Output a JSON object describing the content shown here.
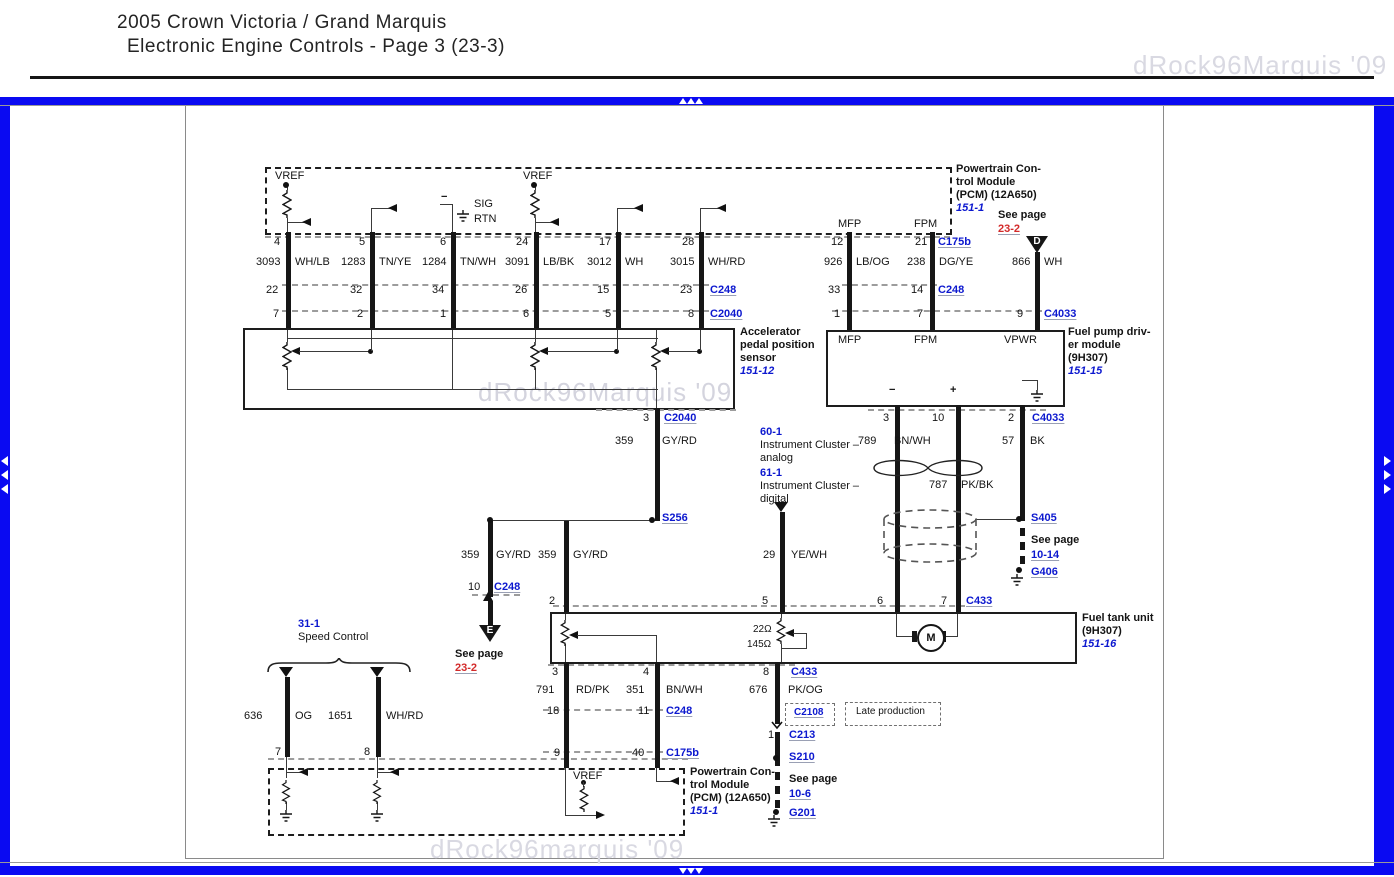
{
  "header": {
    "title1": "2005 Crown Victoria / Grand Marquis",
    "title2": "Electronic Engine Controls - Page 3 (23-3)"
  },
  "watermarks": {
    "top_right": "dRock96Marquis '09",
    "center": "dRock96Marquis '09",
    "bottom": "dRock96marquis '09"
  },
  "pcm_top": {
    "vref_left": "VREF",
    "vref_right": "VREF",
    "minus": "−",
    "sig": "SIG",
    "rtn": "RTN",
    "mfp": "MFP",
    "fpm": "FPM",
    "label1": "Powertrain Con-",
    "label2": "trol Module",
    "label3": "(PCM) (12A650)",
    "ref": "151-1",
    "see_page": "See page",
    "see_page_num": "23-2",
    "d": "D"
  },
  "pins": {
    "row1": [
      "4",
      "5",
      "6",
      "24",
      "17",
      "28"
    ],
    "row1r": [
      "12",
      "21"
    ],
    "c175b": "C175b",
    "row2": [
      "22",
      "32",
      "34",
      "26",
      "15",
      "23"
    ],
    "c248l": "C248",
    "row2r": [
      "33",
      "14"
    ],
    "c248r": "C248",
    "row3": [
      "7",
      "2",
      "1",
      "6",
      "5",
      "8"
    ],
    "c2040": "C2040",
    "row3r": [
      "1",
      "7",
      "9"
    ],
    "c4033": "C4033"
  },
  "wires": {
    "w3093": {
      "g": "3093",
      "c": "WH/LB"
    },
    "w1283": {
      "g": "1283",
      "c": "TN/YE"
    },
    "w1284": {
      "g": "1284",
      "c": "TN/WH"
    },
    "w3091": {
      "g": "3091",
      "c": "LB/BK"
    },
    "w3012": {
      "g": "3012",
      "c": "WH"
    },
    "w3015": {
      "g": "3015",
      "c": "WH/RD"
    },
    "w926": {
      "g": "926",
      "c": "LB/OG"
    },
    "w238": {
      "g": "238",
      "c": "DG/YE"
    },
    "w866": {
      "g": "866",
      "c": "WH"
    },
    "w359a": {
      "g": "359",
      "c": "GY/RD"
    },
    "w359b": {
      "g": "359",
      "c": "GY/RD"
    },
    "w359c": {
      "g": "359",
      "c": "GY/RD"
    },
    "w789": {
      "g": "789",
      "c": "BN/WH"
    },
    "w787": {
      "g": "787",
      "c": "PK/BK"
    },
    "w57": {
      "g": "57",
      "c": "BK"
    },
    "w29": {
      "g": "29",
      "c": "YE/WH"
    },
    "w791": {
      "g": "791",
      "c": "RD/PK"
    },
    "w351": {
      "g": "351",
      "c": "BN/WH"
    },
    "w676": {
      "g": "676",
      "c": "PK/OG"
    },
    "w636": {
      "g": "636",
      "c": "OG"
    },
    "w1651": {
      "g": "1651",
      "c": "WH/RD"
    }
  },
  "app_sensor": {
    "pin3": "3",
    "c2040": "C2040",
    "label1": "Accelerator",
    "label2": "pedal position",
    "label3": "sensor",
    "ref": "151-12"
  },
  "fpdm": {
    "mfp": "MFP",
    "fpm": "FPM",
    "vpwr": "VPWR",
    "minus": "−",
    "plus": "+",
    "label1": "Fuel pump driv-",
    "label2": "er module",
    "label3": "(9H307)",
    "ref": "151-15",
    "pins": [
      "3",
      "10",
      "2"
    ],
    "c4033": "C4033"
  },
  "cluster": {
    "ref_analog": "60-1",
    "analog_line1": "Instrument Cluster –",
    "analog_line2": "analog",
    "ref_digital": "61-1",
    "digital_line1": "Instrument Cluster –",
    "digital_line2": "digital"
  },
  "splices": {
    "s256": "S256",
    "s405": "S405",
    "s210": "S210",
    "g406": "G406",
    "g201": "G201",
    "see_page_1014": "See page",
    "p1014": "10-14",
    "see_page_106": "See page",
    "p106": "10-6"
  },
  "mid": {
    "pin10": "10",
    "c248": "C248",
    "e": "E",
    "see_page": "See page",
    "see_page_num": "23-2"
  },
  "ftu": {
    "pins_top": [
      "2",
      "5",
      "6",
      "7"
    ],
    "c433t": "C433",
    "r22": "22Ω",
    "r145": "145Ω",
    "m": "M",
    "label1": "Fuel tank unit",
    "label2": "(9H307)",
    "ref": "151-16",
    "pins_bot": [
      "3",
      "4",
      "8"
    ],
    "c433b": "C433"
  },
  "bottom": {
    "pins_c248": [
      "18",
      "11"
    ],
    "c248": "C248",
    "pins_c175b": [
      "9",
      "40"
    ],
    "c175b": "C175b",
    "c2108": "C2108",
    "late": "Late production",
    "pin1": "1",
    "c213": "C213",
    "vref": "VREF",
    "pcm1": "Powertrain Con-",
    "pcm2": "trol Module",
    "pcm3": "(PCM) (12A650)",
    "pcm_ref": "151-1"
  },
  "speed": {
    "ref": "31-1",
    "label": "Speed Control",
    "pins": [
      "7",
      "8"
    ]
  },
  "colors": {
    "frame_blue": "#0a0af2",
    "link_blue": "#0c18cf",
    "ref_red": "#d32a2a",
    "wire_black": "#161616"
  }
}
